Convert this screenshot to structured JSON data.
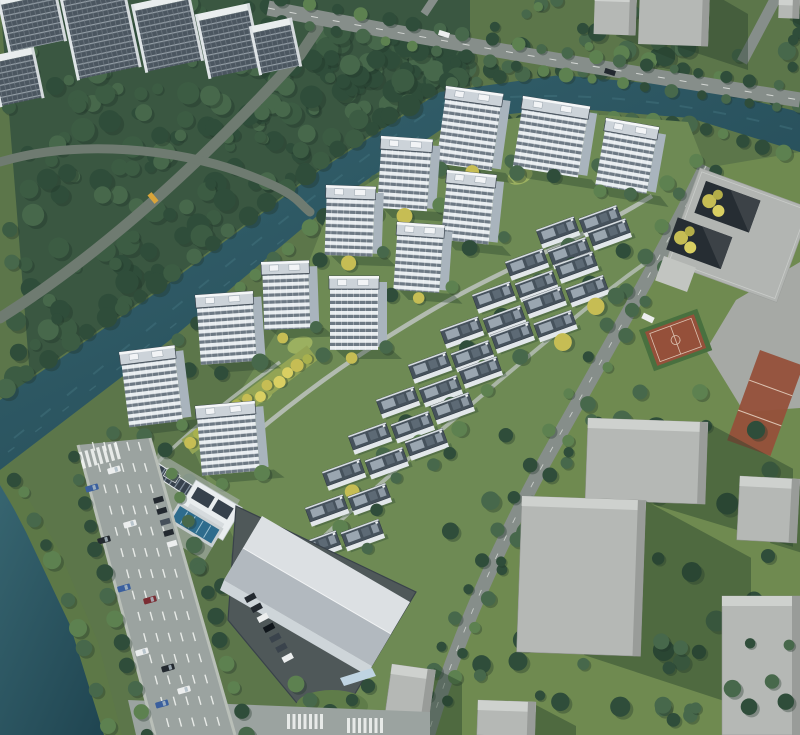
{
  "scene": {
    "type": "aerial-architectural-rendering",
    "description": "Bird's-eye architectural rendering of a riverside residential development: white high-rise apartment towers and diagonal rows of low-rise townhouses set in landscaped green grounds, bordered by a teal canal with wooded banks on the upper left, a wide multi-lane avenue with traffic on the lower left, an amenity clubhouse with swimming pool and solar canopy at the entrance, a large light-gray warehouse-style building at the bottom, a gray school building with twin courtyards, basketball courts and plain gray context massing blocks on the right, and rows of existing housing slabs in the forest at the top left.",
    "elements": {
      "residential_towers": 12,
      "townhouse_rows": 10,
      "context_tower_slabs": 6,
      "context_massing_blocks": 6,
      "context_gray_towers": 3,
      "sports_courts": 2,
      "has_canal": true,
      "has_swimming_pool": true,
      "has_solar_canopy": true,
      "has_warehouse": true,
      "has_school_with_courtyards": true
    }
  },
  "palette": {
    "base": "#5c764a",
    "site": "#6e8a54",
    "contextGrass": "#647e4c",
    "forest": "#3a5741",
    "treeDark": "#2f4d3a",
    "treeMid": "#47684b",
    "treeBright": "#5d8150",
    "treeYellow": "#c6bd54",
    "treeYellowLight": "#d9cf62",
    "treeShadow": "#1f3527",
    "water": "#2b5560",
    "waterLight": "#447680",
    "waterDark": "#1f4450",
    "bankGrass": "#5d7847",
    "roadMain": "#9ba3a0",
    "roadMinor": "#868e8a",
    "roadForest": "#6f7b71",
    "lane": "#f5f7f4",
    "sidewalk": "#b9bfb8",
    "towerFace": "#e8edf0",
    "towerWin": "#6d7984",
    "towerSide": "#a9b4bd",
    "towerRoof": "#ccd3d9",
    "towerTrim": "#f4f6f7",
    "towerDark": "#3d4751",
    "slabFace": "#4b5660",
    "slabLine": "#949ea6",
    "slabRoof": "#e9edee",
    "thRoof": "#46525c",
    "thPanel": "#9aa6b0",
    "thPanelDark": "#5d6a75",
    "thWall": "#e2e7ea",
    "blockFront": "#b5b8b5",
    "blockTop": "#ced1ce",
    "blockSide": "#999c99",
    "school": "#b2b5b2",
    "courtyard": "#262d33",
    "plaza": "#a6a9a5",
    "courtRed": "#95503a",
    "courtLine": "#dcc3b2",
    "pool": "#2e6c8d",
    "poolLane": "#b7d6e2",
    "solar": "#36414c",
    "solarLine": "#8593a0",
    "whRoof": "#dce0e3",
    "whShade": "#b2b9bf",
    "whWall": "#ced5d9",
    "glass": "#bfd4e2",
    "asphalt": "#4f5859",
    "shadow": "#233d2a",
    "pathGray": "#b9c0ba",
    "carWhite": "#eceeee",
    "carDark": "#23292f",
    "carBlue": "#3a5f9e",
    "carYellow": "#d9a43a",
    "carRed": "#7b2d33"
  }
}
